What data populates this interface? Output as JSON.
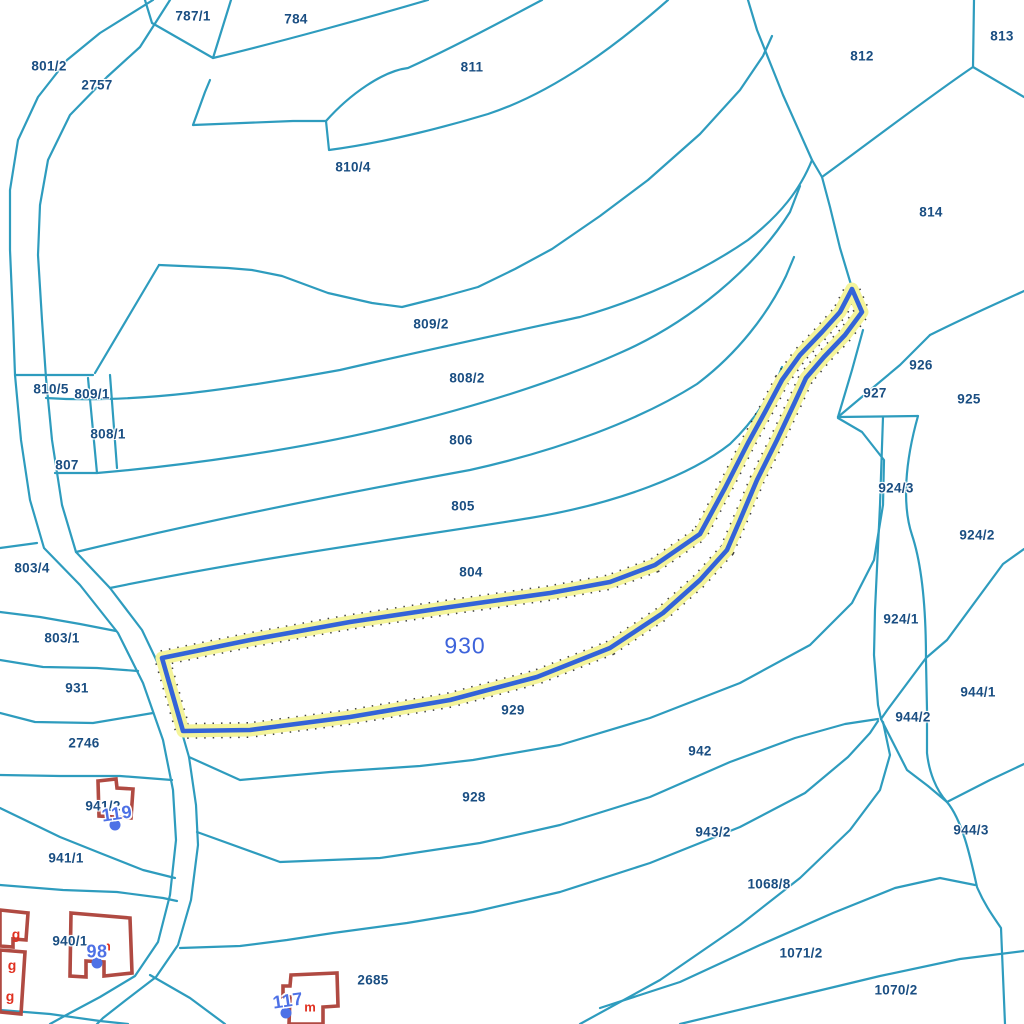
{
  "map": {
    "type": "cadastral-parcel-map",
    "background": "#ffffff",
    "colors": {
      "bg": "#ffffff",
      "teal": "#2E9CBE",
      "lblue": "#1A4E82",
      "hblue": "#3363D8",
      "halo": "#F4F49B",
      "hlabel": "#3D63DB",
      "bred": "#B04A42",
      "mblue": "#4E71E6",
      "ared": "#E03020"
    },
    "highlighted_parcel": {
      "id": "930",
      "label": {
        "text": "930",
        "x": 465,
        "y": 646
      }
    },
    "parcel_labels": [
      {
        "text": "787/1",
        "x": 193,
        "y": 16
      },
      {
        "text": "784",
        "x": 296,
        "y": 19
      },
      {
        "text": "801/2",
        "x": 49,
        "y": 66
      },
      {
        "text": "2757",
        "x": 97,
        "y": 85
      },
      {
        "text": "811",
        "x": 472,
        "y": 67
      },
      {
        "text": "812",
        "x": 862,
        "y": 56
      },
      {
        "text": "813",
        "x": 1002,
        "y": 36
      },
      {
        "text": "810/4",
        "x": 353,
        "y": 167
      },
      {
        "text": "814",
        "x": 931,
        "y": 212
      },
      {
        "text": "809/2",
        "x": 431,
        "y": 324
      },
      {
        "text": "810/5",
        "x": 51,
        "y": 389
      },
      {
        "text": "809/1",
        "x": 92,
        "y": 394
      },
      {
        "text": "808/2",
        "x": 467,
        "y": 378
      },
      {
        "text": "926",
        "x": 921,
        "y": 365
      },
      {
        "text": "927",
        "x": 875,
        "y": 393
      },
      {
        "text": "925",
        "x": 969,
        "y": 399
      },
      {
        "text": "808/1",
        "x": 108,
        "y": 434
      },
      {
        "text": "806",
        "x": 461,
        "y": 440
      },
      {
        "text": "807",
        "x": 67,
        "y": 465
      },
      {
        "text": "924/3",
        "x": 896,
        "y": 488
      },
      {
        "text": "805",
        "x": 463,
        "y": 506
      },
      {
        "text": "924/2",
        "x": 977,
        "y": 535
      },
      {
        "text": "803/4",
        "x": 32,
        "y": 568
      },
      {
        "text": "804",
        "x": 471,
        "y": 572
      },
      {
        "text": "924/1",
        "x": 901,
        "y": 619
      },
      {
        "text": "803/1",
        "x": 62,
        "y": 638
      },
      {
        "text": "944/1",
        "x": 978,
        "y": 692
      },
      {
        "text": "931",
        "x": 77,
        "y": 688
      },
      {
        "text": "929",
        "x": 513,
        "y": 710
      },
      {
        "text": "944/2",
        "x": 913,
        "y": 717
      },
      {
        "text": "2746",
        "x": 84,
        "y": 743
      },
      {
        "text": "942",
        "x": 700,
        "y": 751
      },
      {
        "text": "928",
        "x": 474,
        "y": 797
      },
      {
        "text": "941/2",
        "x": 103,
        "y": 806
      },
      {
        "text": "943/2",
        "x": 713,
        "y": 832
      },
      {
        "text": "944/3",
        "x": 971,
        "y": 830
      },
      {
        "text": "941/1",
        "x": 66,
        "y": 858
      },
      {
        "text": "1068/8",
        "x": 769,
        "y": 884
      },
      {
        "text": "940/1",
        "x": 70,
        "y": 941
      },
      {
        "text": "1071/2",
        "x": 801,
        "y": 953
      },
      {
        "text": "2685",
        "x": 373,
        "y": 980
      },
      {
        "text": "1070/2",
        "x": 896,
        "y": 990
      }
    ],
    "house_numbers": [
      {
        "text": "119",
        "x": 117,
        "y": 814,
        "rot": -8
      },
      {
        "text": "98",
        "x": 97,
        "y": 952,
        "rot": 0
      },
      {
        "text": "117",
        "x": 288,
        "y": 1001,
        "rot": -8
      }
    ],
    "point_markers": [
      {
        "x": 115,
        "y": 825
      },
      {
        "x": 97,
        "y": 963
      },
      {
        "x": 286,
        "y": 1013
      }
    ],
    "outbuilding_labels": [
      {
        "text": "g",
        "x": 16,
        "y": 934
      },
      {
        "text": "g",
        "x": 12,
        "y": 965
      },
      {
        "text": "g",
        "x": 10,
        "y": 996
      }
    ],
    "unit_labels": [
      {
        "text": "m",
        "x": 310,
        "y": 1007
      },
      {
        "text": "m",
        "x": 105,
        "y": 946
      }
    ]
  }
}
